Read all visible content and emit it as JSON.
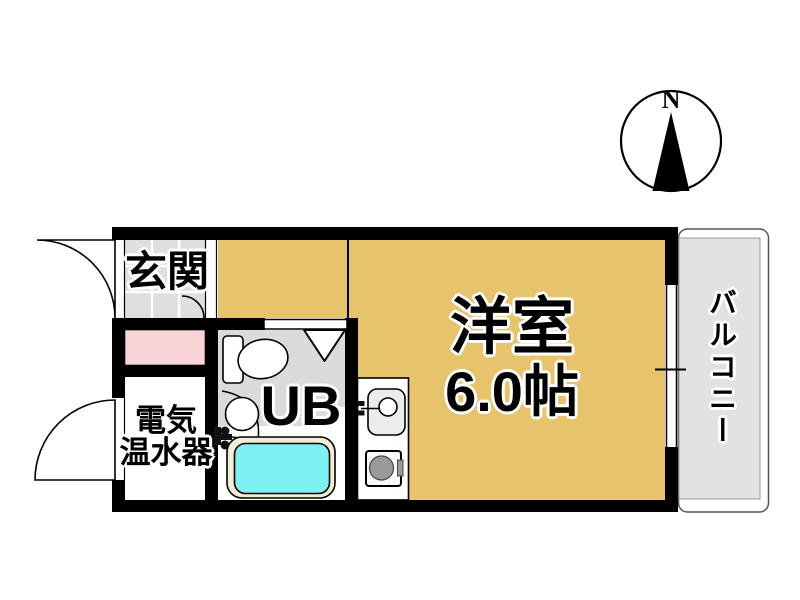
{
  "compass": {
    "label": "N"
  },
  "rooms": {
    "genkan": {
      "label": "玄関"
    },
    "living": {
      "label": "洋室",
      "size": "6.0帖"
    },
    "unit_bath": {
      "label": "UB"
    },
    "water_heater": {
      "line1": "電気",
      "line2": "温水器"
    },
    "balcony": {
      "label": "バルコニー"
    }
  },
  "colors": {
    "room_floor": "#E7C46C",
    "genkan_tile": "#DFDFDF",
    "unit_bath_floor": "#DBDBDB",
    "closet_pink": "#F9D4D7",
    "bathtub_water": "#7EF2F2",
    "bathtub_rim": "#F2EDD3",
    "balcony_floor": "#E2E2E2",
    "wall": "#000000"
  },
  "icons": [
    "compass-icon",
    "toilet-icon",
    "washbasin-icon",
    "bathtub-icon",
    "folding-door-icon",
    "door-swing-icon",
    "window-icon",
    "kitchen-sink-icon",
    "stove-icon"
  ]
}
